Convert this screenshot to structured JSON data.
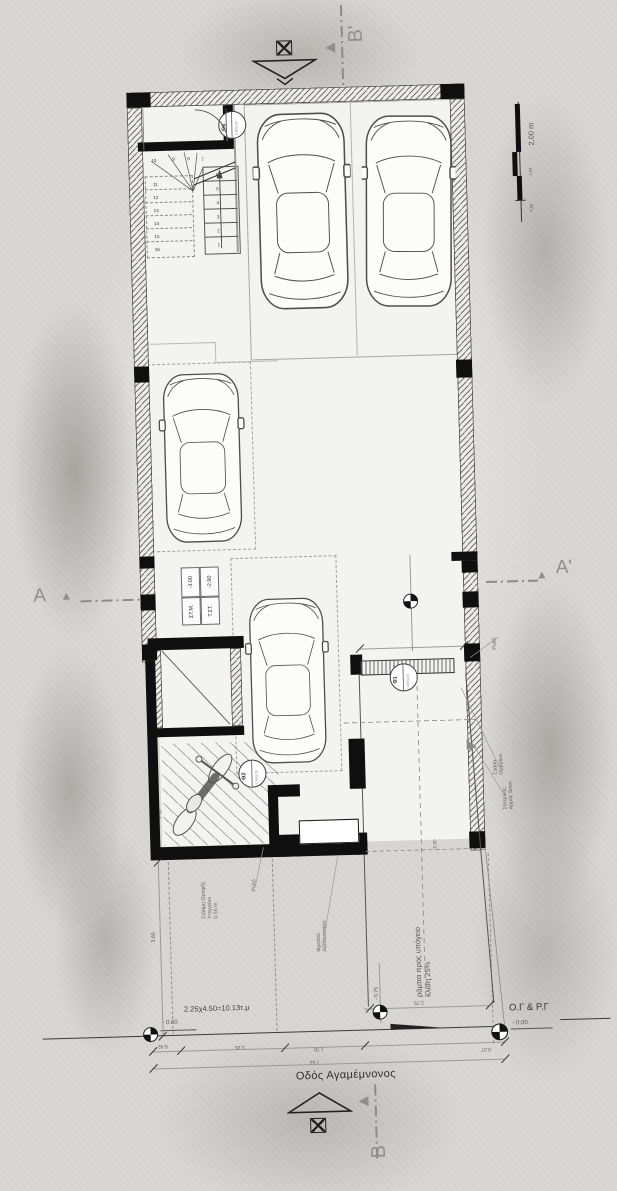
{
  "drawing": {
    "street_label": "Οδός Αγαμέμνονος",
    "boundary_label": "Ο.Γ & Ρ.Γ"
  },
  "section_markers": {
    "a": "A",
    "a_prime": "A'",
    "b": "B",
    "b_prime": "B'"
  },
  "scale_bar": {
    "label_2m": "2,00 m",
    "label_1m": "1,00",
    "label_05m": "0,50"
  },
  "rooms": {
    "storage": "Αποθήκη",
    "lift": "Lift"
  },
  "stairs": {
    "numbers": [
      "1",
      "2",
      "3",
      "4",
      "5",
      "6",
      "7",
      "8",
      "9",
      "10",
      "11",
      "12",
      "13",
      "14",
      "15",
      "16"
    ]
  },
  "door_markers": {
    "theta1": "Θ1",
    "theta2": "Θ2",
    "theta3": "Θ3",
    "size": "0.90/2.20"
  },
  "level_table": {
    "r1_label": "ΣΤ.Μ.",
    "r1_value": "-3.00",
    "r2_label": "Τ.ΣΤ.",
    "r2_value": "-2.90"
  },
  "levels": {
    "garage": "- 3.00",
    "street_low": "- 0.60",
    "street_mid": "- 0.75",
    "street_zero": "- 0.00"
  },
  "areas": {
    "parking_interior": "2.00χ5.50=11.00τ.μ",
    "parking_street": "2.25χ4.50=10.13τ.μ"
  },
  "annotations": {
    "slab_projection": "προβολή πλάκας ισογείου",
    "ramp_l1": "ράμπα προς υπόγειο",
    "ramp_l2": "κλίση 25%",
    "roller_right": "Ρολό",
    "roller_left": "Ρολό",
    "grate_l1": "Σχάρα",
    "grate_l2": "Ομβρίων",
    "joint_l1": "Σεισμικός",
    "joint_l2": "Αρμός 5mm",
    "shaft_l1": "Φρεάτιο",
    "shaft_l2": "Ανελκυστήρα",
    "ceiling_l1": "Στάθμη Οροφής",
    "ceiling_l2": "Υπογείου",
    "ceiling_l3": "0.55 m"
  },
  "dimensions": {
    "stair_width": "1.28",
    "bay_150": "1.50",
    "lift_h": "1.70",
    "lift_w": "1.50",
    "room_234": "2.34",
    "room_235": "2.35",
    "window_160": "1.60",
    "ramp_top": "2.48",
    "ramp_len": "6.00",
    "ramp_bottom": "2.75",
    "front_360": "3.60",
    "chain_042": "0.42",
    "chain_225": "2.25",
    "chain_170": "1.70",
    "chain_total": "7.52",
    "chain_037": "0.37"
  },
  "colors": {
    "line": "#2a2a2a",
    "gray_marker": "#8f8f8f",
    "paper": "#d8d7d4"
  }
}
